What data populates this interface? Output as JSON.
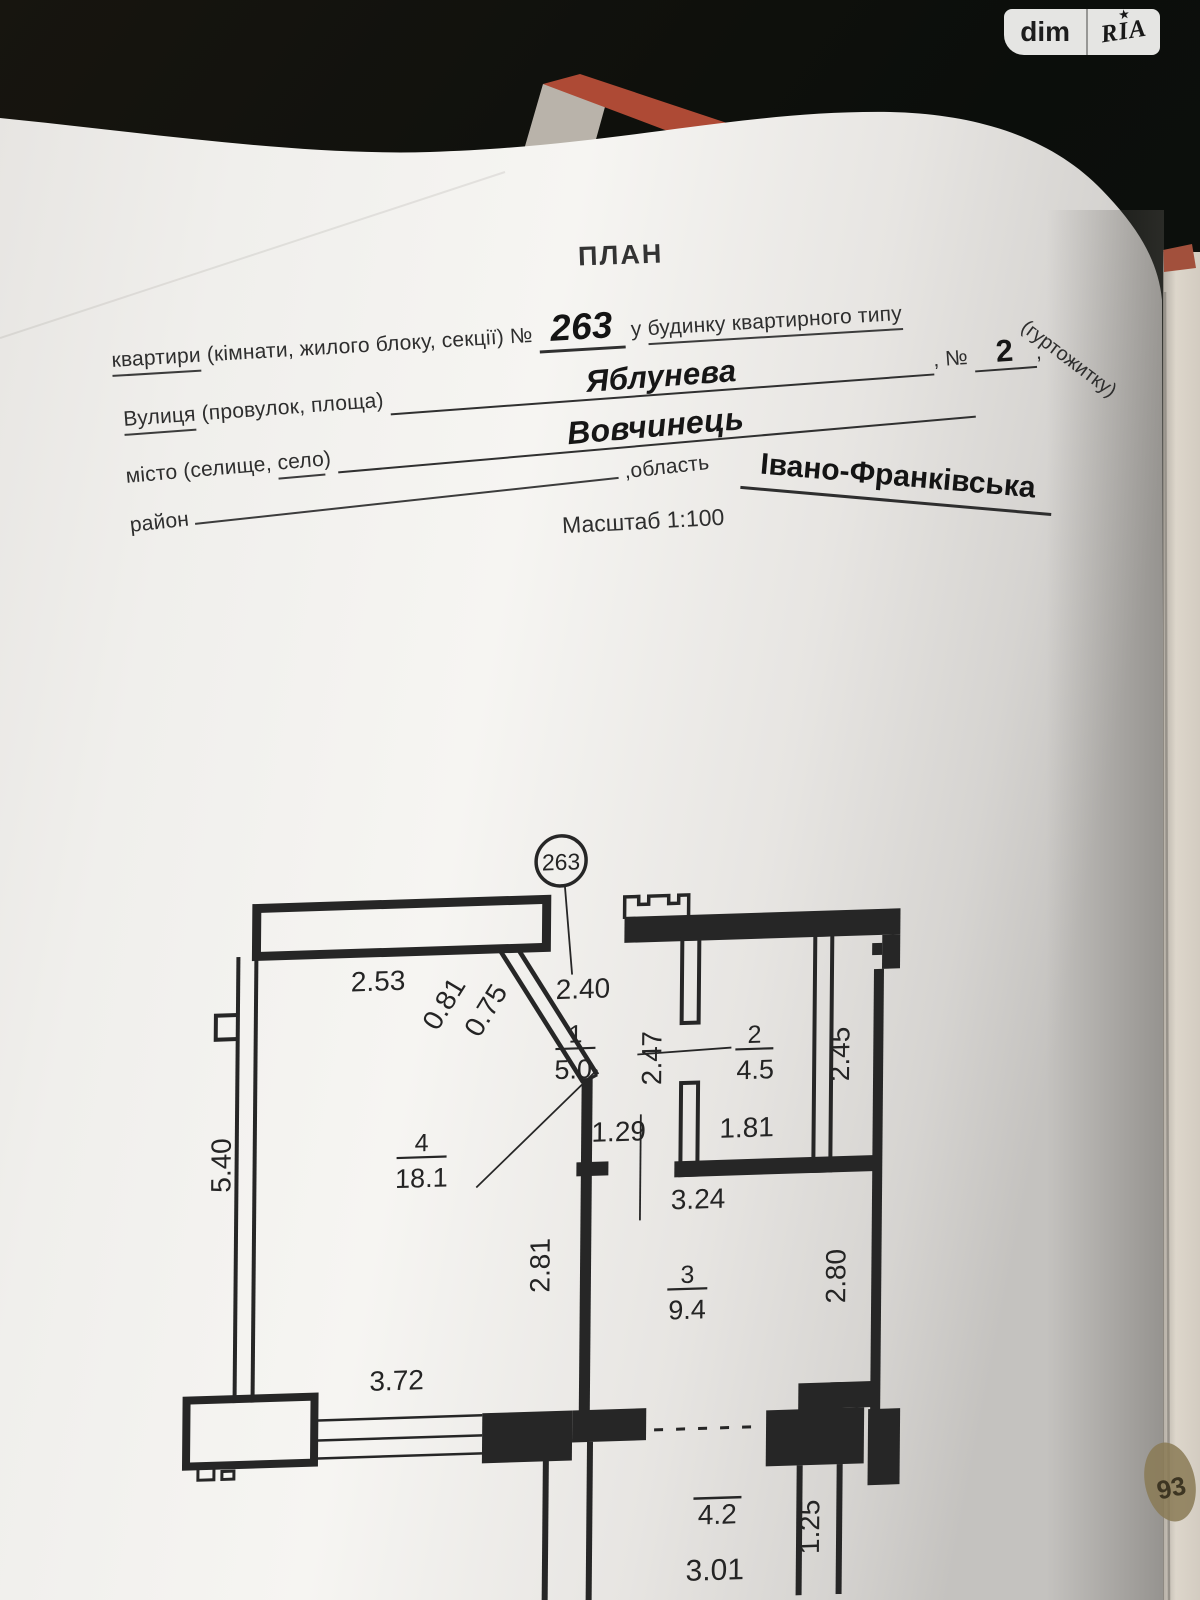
{
  "watermark": {
    "left": "dim",
    "right": "RIA",
    "star_icon": "★"
  },
  "form": {
    "title": "ПЛАН",
    "line1": {
      "word_underlined": "квартири",
      "middle": " (кімнати, жилого блоку, секції) № ",
      "number": "263",
      "connector": " у ",
      "suffix_underlined": "будинку квартирного типу",
      "tail": "(гуртожитку)"
    },
    "street": {
      "word_underlined": "Вулиця",
      "label_rest": " (провулок, площа) ",
      "value": "Яблунева",
      "separator": ", № ",
      "number": "2",
      "trailing_comma": ","
    },
    "city": {
      "label_a": "місто (селище, ",
      "word_underlined": "село",
      "label_b": ") ",
      "value": "Вовчинець"
    },
    "district": {
      "label": "район",
      "oblast_label": " ,область ",
      "value": "Івано-Франківська"
    },
    "scale": "Масштаб 1:100"
  },
  "plan": {
    "unit_number": "263",
    "rooms": [
      {
        "number": "1",
        "area": "5.0"
      },
      {
        "number": "2",
        "area": "4.5"
      },
      {
        "number": "3",
        "area": "9.4"
      },
      {
        "number": "4",
        "area": "18.1"
      }
    ],
    "dims": {
      "top_left": "2.53",
      "diag_a": "0.81",
      "diag_b": "0.75",
      "entry_width": "2.40",
      "hall_side": "2.47",
      "shaft_side": "2.45",
      "hall_opening": "1.29",
      "room2_width": "1.81",
      "room3_width": "3.24",
      "left_side": "5.40",
      "inner_wall": "2.81",
      "room3_side": "2.80",
      "window_width": "3.72"
    },
    "balcony": {
      "area": "4.2",
      "width": "3.01",
      "depth": "1.25"
    }
  },
  "stamp_fragment": "93"
}
